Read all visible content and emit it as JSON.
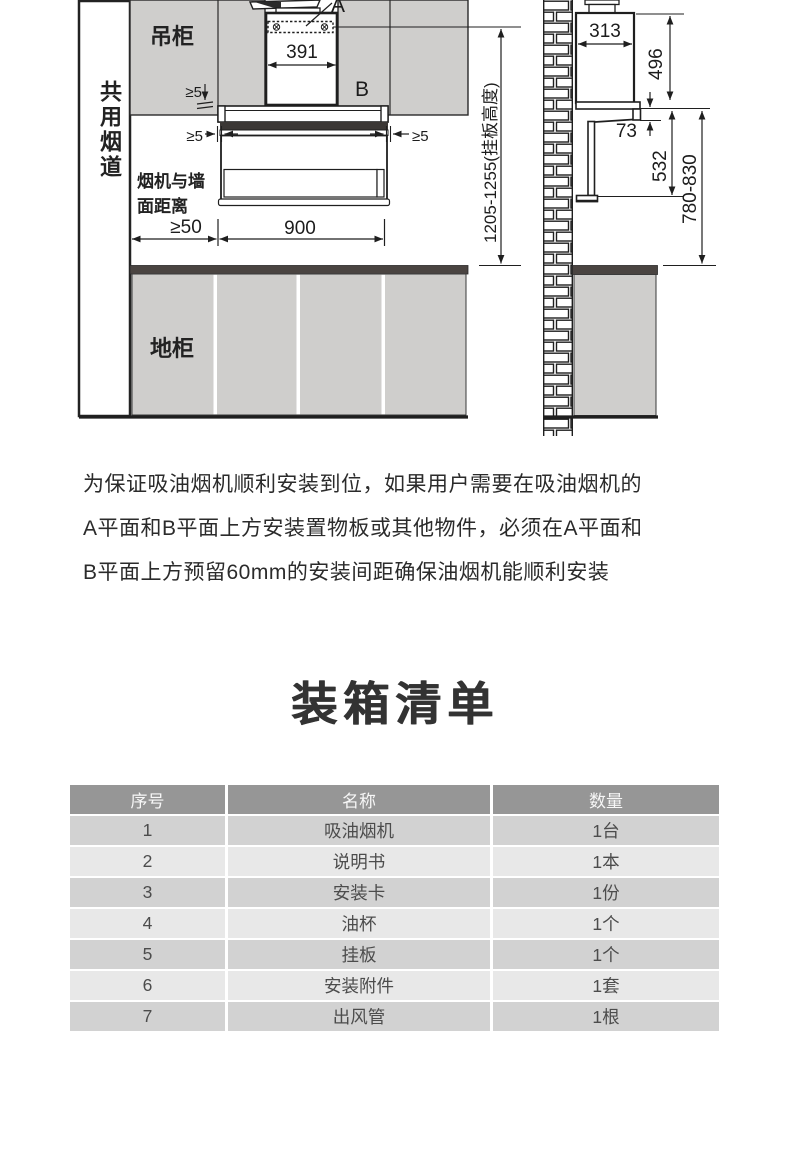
{
  "diagram": {
    "labels": {
      "shared_flue": "共用烟道",
      "wall_cabinet": "吊柜",
      "base_cabinet": "地柜",
      "wall_distance": "烟机与墙面距离",
      "plane_a": "A",
      "plane_b": "B"
    },
    "dimensions": {
      "chimney_width": "391",
      "top_gap": "≥5",
      "left_gap": "≥5",
      "right_gap": "≥5",
      "flue_clearance": "≥50",
      "hood_width": "900",
      "hang_height": "1205-1255(挂板高度)",
      "depth": "313",
      "chimney_height": "496",
      "front_lip": "73",
      "body_height": "532",
      "counter_height": "780-830"
    },
    "colors": {
      "cabinet": "#cfcecc",
      "countertop": "#4a4441",
      "line": "#1f1f1f"
    }
  },
  "note": {
    "lines": [
      "为保证吸油烟机顺利安装到位，如果用户需要在吸油烟机的",
      "A平面和B平面上方安装置物板或其他物件，必须在A平面和",
      "B平面上方预留60mm的安装间距确保油烟机能顺利安装"
    ]
  },
  "packing_list": {
    "title": "装箱清单",
    "columns": [
      "序号",
      "名称",
      "数量"
    ],
    "rows": [
      [
        "1",
        "吸油烟机",
        "1台"
      ],
      [
        "2",
        "说明书",
        "1本"
      ],
      [
        "3",
        "安装卡",
        "1份"
      ],
      [
        "4",
        "油杯",
        "1个"
      ],
      [
        "5",
        "挂板",
        "1个"
      ],
      [
        "6",
        "安装附件",
        "1套"
      ],
      [
        "7",
        "出风管",
        "1根"
      ]
    ]
  }
}
